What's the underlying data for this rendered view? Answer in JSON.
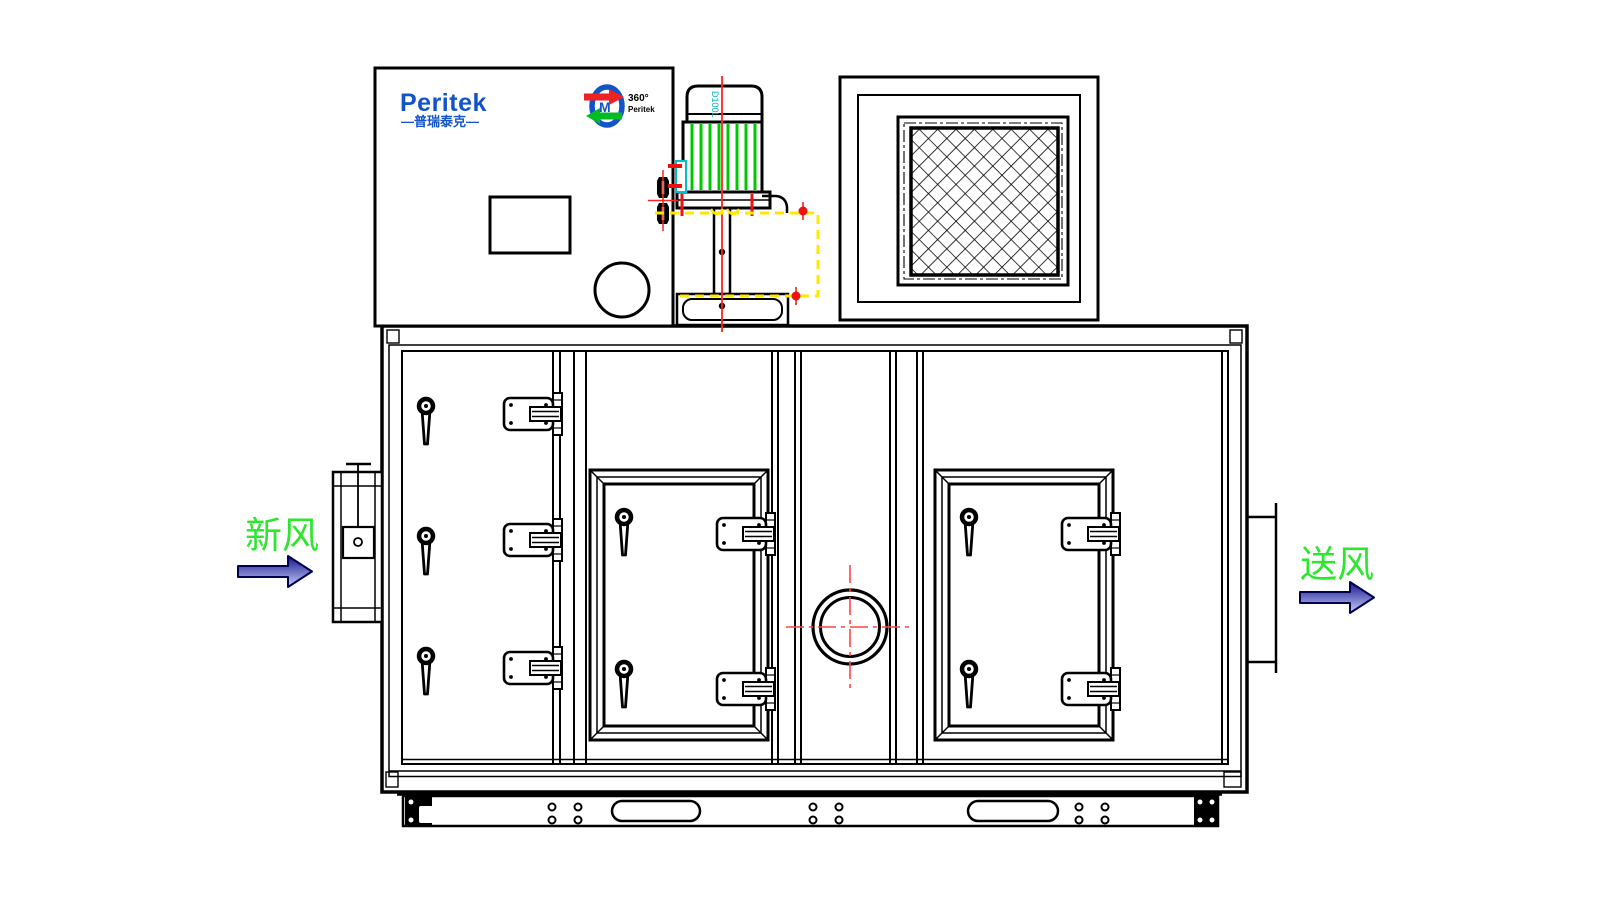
{
  "drawing": {
    "brand": {
      "logo_text": "Peritek",
      "logo_subtext": "—普瑞泰克—",
      "wheel_logo": {
        "degree_text": "360°",
        "name_text": "Peritek"
      }
    },
    "motor": {
      "model_label": "D100L"
    },
    "airflow": {
      "inlet_label": "新风",
      "outlet_label": "送风"
    },
    "colors": {
      "background": "#FFFFFF",
      "line_black": "#000000",
      "brand_blue": "#1353CA",
      "centerline_red": "#FF2020",
      "motor_fin_green": "#00C800",
      "hatch_yellow": "#FFE800",
      "detail_cyan": "#00C0D0",
      "label_green": "#2EE62E",
      "arrow_dark_blue": "#14148C",
      "arrow_light_blue": "#C8CEFA"
    }
  }
}
